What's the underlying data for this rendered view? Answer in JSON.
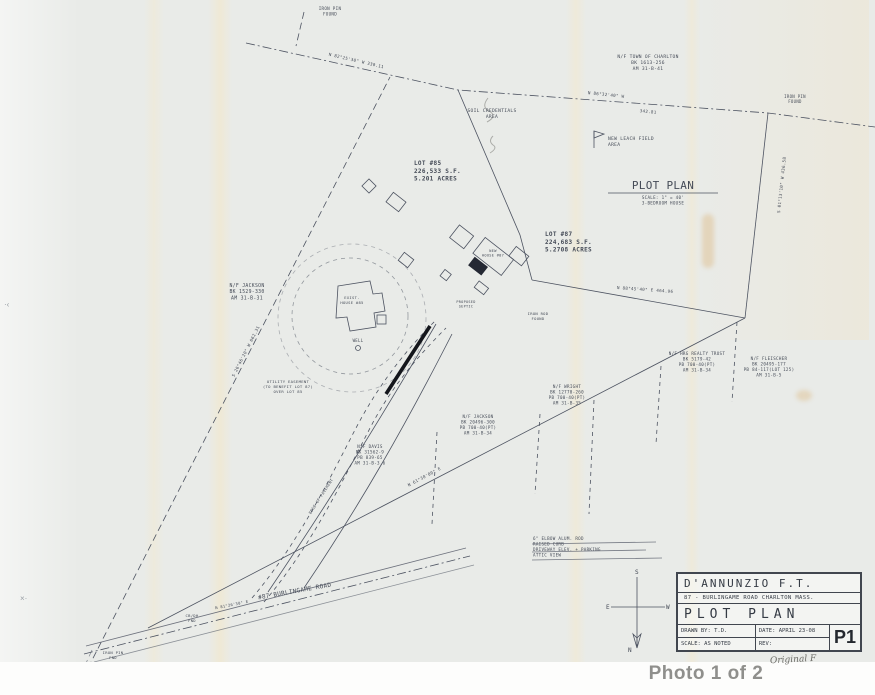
{
  "caption": "Photo 1 of 2",
  "colors": {
    "ink": "#4d5361",
    "paper": "#e9ebe8",
    "caption_gray": "#8f8f8c",
    "stamp_orange": "#d69a3f"
  },
  "plan": {
    "title_block": {
      "owner": "D'ANNUNZIO  F.T.",
      "address": "87 - BURLINGAME ROAD   CHARLTON   MASS.",
      "title": "PLOT  PLAN",
      "drawn_by": "DRAWN BY: T.D.",
      "date": "DATE: APRIL 23-08",
      "scale": "SCALE: AS NOTED",
      "rev": "REV:",
      "sheet": "P1",
      "note_below": "Original F"
    },
    "compass": {
      "north": "N",
      "south": "S",
      "east": "E",
      "west": "W"
    },
    "labels": [
      {
        "name": "iron-pin-label",
        "text": [
          "IRON PIN",
          "FOUND"
        ],
        "x": 330,
        "y": 10,
        "size": 4.2
      },
      {
        "name": "bearing-label",
        "text": [
          "N 82°25'30\" W  330.11"
        ],
        "x": 356,
        "y": 62,
        "size": 4.2,
        "rot": 13
      },
      {
        "name": "bearing-label",
        "text": [
          "N 86°32'40\" W"
        ],
        "x": 606,
        "y": 96,
        "size": 4.2,
        "rot": 6
      },
      {
        "name": "distance-label",
        "text": [
          "342.81"
        ],
        "x": 648,
        "y": 113,
        "size": 4.2,
        "rot": 6
      },
      {
        "name": "abutter-label",
        "text": [
          "N/F TOWN OF CHARLTON",
          "BK 1613-256",
          "AM 31-B-41"
        ],
        "x": 648,
        "y": 58,
        "size": 4.6
      },
      {
        "name": "iron-pin-label",
        "text": [
          "IRON PIN",
          "FOUND"
        ],
        "x": 795,
        "y": 98,
        "size": 4
      },
      {
        "name": "bearing-label",
        "text": [
          "S 01°13'10\" W  436.58"
        ],
        "x": 783,
        "y": 185,
        "size": 4.2,
        "rot": -84
      },
      {
        "name": "area-note",
        "text": [
          "SOIL CREDENTIALS",
          "AREA"
        ],
        "x": 492,
        "y": 112,
        "size": 4.6
      },
      {
        "name": "lot-85-label",
        "text": [
          "LOT #85",
          "226,533 S.F.",
          "5.201 ACRES"
        ],
        "x": 414,
        "y": 165,
        "size": 6,
        "anchor": "start",
        "bold": true
      },
      {
        "name": "leach-field-label",
        "text": [
          "NEW LEACH FIELD",
          "AREA"
        ],
        "x": 608,
        "y": 140,
        "size": 4.6,
        "anchor": "start"
      },
      {
        "name": "plot-plan-heading",
        "text": [
          "PLOT PLAN"
        ],
        "x": 663,
        "y": 189,
        "size": 11,
        "ls": 3.5
      },
      {
        "name": "plot-plan-subtitle",
        "text": [
          "SCALE: 1\" = 40'",
          "3-BEDROOM HOUSE"
        ],
        "x": 663,
        "y": 199,
        "size": 4.2
      },
      {
        "name": "lot-87-label",
        "text": [
          "LOT #87",
          "224,683 S.F.",
          "5.2708 ACRES"
        ],
        "x": 545,
        "y": 236,
        "size": 6,
        "anchor": "start",
        "bold": true
      },
      {
        "name": "abutter-label",
        "text": [
          "N/F JACKSON",
          "BK 1529-330",
          "AM 31-B-31"
        ],
        "x": 247,
        "y": 287,
        "size": 4.8
      },
      {
        "name": "easement-note",
        "text": [
          "UTILITY EASEMENT",
          "(TO BENEFIT LOT 87)",
          "OVER LOT 85"
        ],
        "x": 288,
        "y": 383,
        "size": 3.9
      },
      {
        "name": "bearing-label",
        "text": [
          "S 26°46'20\" W  662.31"
        ],
        "x": 247,
        "y": 352,
        "size": 4.2,
        "rot": -63
      },
      {
        "name": "existing-house-label",
        "text": [
          "EXIST.",
          "HOUSE #85"
        ],
        "x": 352,
        "y": 299,
        "size": 3.8
      },
      {
        "name": "well-label",
        "text": [
          "WELL"
        ],
        "x": 358,
        "y": 342,
        "size": 4
      },
      {
        "name": "new-house-label",
        "text": [
          "NEW",
          "HOUSE #87"
        ],
        "x": 493,
        "y": 252,
        "size": 3.6
      },
      {
        "name": "septic-label",
        "text": [
          "PROPOSED",
          "SEPTIC"
        ],
        "x": 466,
        "y": 303,
        "size": 3.5
      },
      {
        "name": "iron-rod-label",
        "text": [
          "IRON ROD",
          "FOUND"
        ],
        "x": 538,
        "y": 315,
        "size": 3.8
      },
      {
        "name": "bearing-label",
        "text": [
          "N 88°45'40\" E  464.96"
        ],
        "x": 645,
        "y": 291,
        "size": 4.2,
        "rot": 4
      },
      {
        "name": "abutter-label",
        "text": [
          "N/F HRG REALTY TRUST",
          "BK 5179-42",
          "PB 700-40(PT)",
          "AM 31-B-34"
        ],
        "x": 697,
        "y": 355,
        "size": 4.2
      },
      {
        "name": "abutter-label",
        "text": [
          "N/F FLEISCHER",
          "BK 20495-177",
          "PB 84-117(LOT 125)",
          "AM 31-B-5"
        ],
        "x": 769,
        "y": 360,
        "size": 4.2
      },
      {
        "name": "abutter-label",
        "text": [
          "N/F WRIGHT",
          "BK 12770-260",
          "PB 700-40(PT)",
          "AM 31-B-35"
        ],
        "x": 567,
        "y": 388,
        "size": 4.2
      },
      {
        "name": "abutter-label",
        "text": [
          "N/F JACKSON",
          "BK 20496-300",
          "PB 700-40(PT)",
          "AM 31-B-34"
        ],
        "x": 478,
        "y": 418,
        "size": 4.2
      },
      {
        "name": "abutter-label",
        "text": [
          "N/F DAVIS",
          "BK 31562-9",
          "PB 839-65",
          "AM 31-B-3.6"
        ],
        "x": 370,
        "y": 448,
        "size": 4.2
      },
      {
        "name": "bearing-label",
        "text": [
          "N 61°30'00\" E"
        ],
        "x": 425,
        "y": 478,
        "size": 4.2,
        "rot": -28
      },
      {
        "name": "pavement-label",
        "text": [
          "EDGE OF PAVEMENT"
        ],
        "x": 322,
        "y": 497,
        "size": 3.8,
        "rot": -57
      },
      {
        "name": "construction-note",
        "text": [
          "6\" ELBOW ALUM. ROD",
          "RAISED CURB",
          "DRIVEWAY ELEV. + PARKING",
          "ATTIC VIEW"
        ],
        "x": 533,
        "y": 540,
        "size": 4.2,
        "anchor": "start"
      },
      {
        "name": "road-name-label",
        "text": [
          "#87 BURLINGAME ROAD"
        ],
        "x": 295,
        "y": 593,
        "size": 6,
        "rot": -10,
        "ls": 1.5
      },
      {
        "name": "bearing-label",
        "text": [
          "N 81°26'30\" E"
        ],
        "x": 232,
        "y": 606,
        "size": 3.8,
        "rot": -11
      },
      {
        "name": "monument-label",
        "text": [
          "CB/DH",
          "FND"
        ],
        "x": 192,
        "y": 617,
        "size": 3.8
      },
      {
        "name": "iron-pin-label",
        "text": [
          "IRON PIN",
          "FND"
        ],
        "x": 113,
        "y": 654,
        "size": 3.8
      },
      {
        "name": "compass-s-label",
        "text": [
          "S"
        ],
        "x": 637,
        "y": 574,
        "size": 6
      },
      {
        "name": "compass-e-label",
        "text": [
          "E"
        ],
        "x": 608,
        "y": 609,
        "size": 6
      },
      {
        "name": "compass-w-label",
        "text": [
          "W"
        ],
        "x": 668,
        "y": 609,
        "size": 6
      },
      {
        "name": "compass-n-label",
        "text": [
          "N"
        ],
        "x": 630,
        "y": 652,
        "size": 6
      }
    ]
  }
}
